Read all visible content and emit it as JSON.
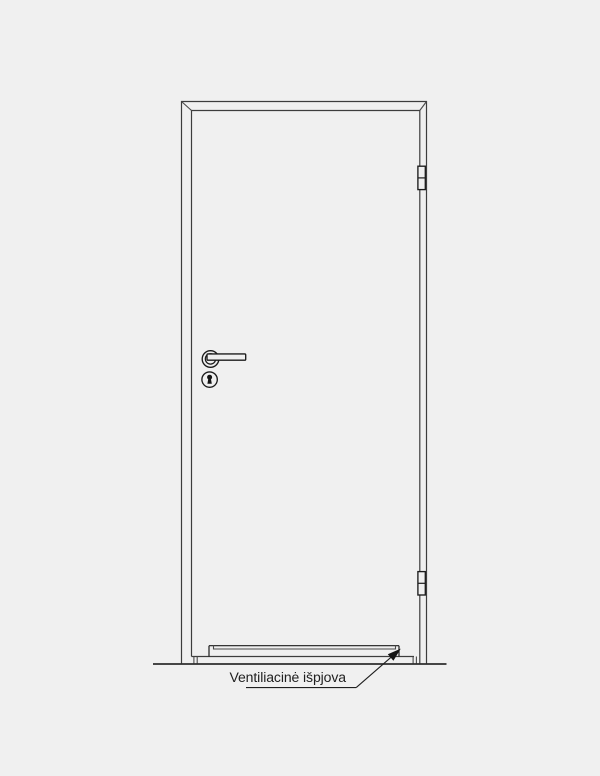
{
  "annotation": {
    "label": "Ventiliacinė išpjova"
  },
  "colors": {
    "background": "#f0f0f0",
    "line": "#3d3d3d",
    "dark_line": "#1c1c1c",
    "text": "#1f1f1f"
  },
  "drawing": {
    "type": "door-elevation-diagram",
    "parts": [
      "door-frame",
      "door-leaf",
      "lever-handle",
      "keyhole",
      "hinge-top",
      "hinge-bottom",
      "ventilation-cutout",
      "floor-line",
      "leader-arrow"
    ]
  }
}
